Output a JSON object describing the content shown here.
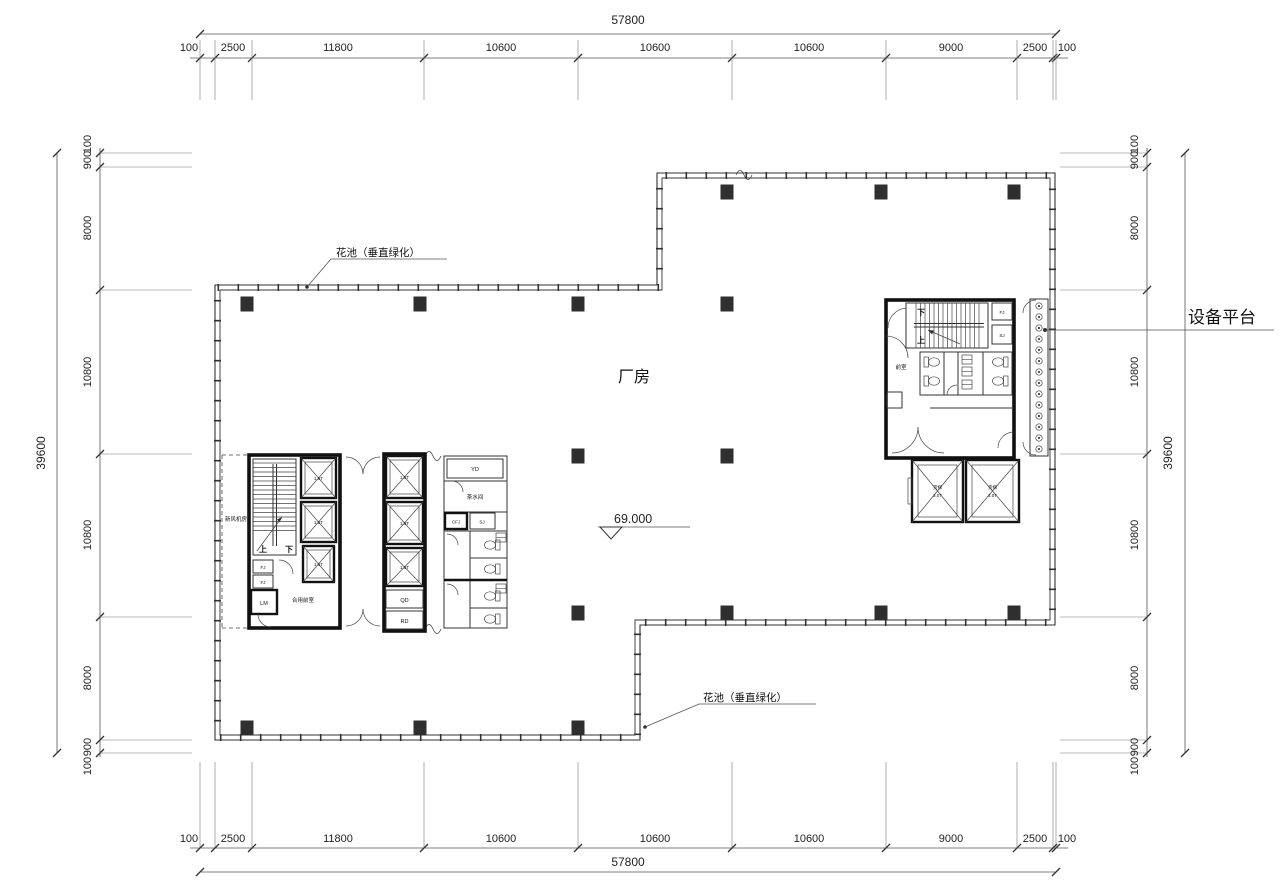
{
  "drawing_type": "floor-plan",
  "dims": {
    "top": {
      "total": "57800",
      "segments": [
        "100",
        "2500",
        "11800",
        "10600",
        "10600",
        "10600",
        "9000",
        "2500",
        "100"
      ]
    },
    "bottom": {
      "total": "57800",
      "segments": [
        "100",
        "2500",
        "11800",
        "10600",
        "10600",
        "10600",
        "9000",
        "2500",
        "100"
      ]
    },
    "left": {
      "total": "39600",
      "segments": [
        "100",
        "900",
        "8000",
        "10800",
        "10800",
        "8000",
        "900",
        "100"
      ]
    },
    "right": {
      "total": "39600",
      "segments": [
        "100",
        "900",
        "8000",
        "10800",
        "10800",
        "8000",
        "900",
        "100"
      ]
    }
  },
  "labels": {
    "factory": "厂房",
    "level": "69.000",
    "equipment_platform": "设备平台",
    "planter": "花池（垂直绿化）",
    "fresh_air_room": "新风机房",
    "combined_lobby": "合用前室",
    "front_room": "前室",
    "tea_room": "茶水间",
    "up": "上",
    "down": "下"
  },
  "rooms": {
    "yd": "YD",
    "cfj": "CFJ",
    "sj": "SJ",
    "fj": "FJ",
    "lm": "LM",
    "qd": "QD",
    "rd": "RD"
  },
  "elevators": {
    "passenger": "1.6T",
    "freight_name": "货梯",
    "freight_cap": "3.0T"
  },
  "colors": {
    "background": "#ffffff",
    "line": "#555555",
    "wall": "#111111",
    "column": "#2f2f2f",
    "text": "#222222"
  }
}
